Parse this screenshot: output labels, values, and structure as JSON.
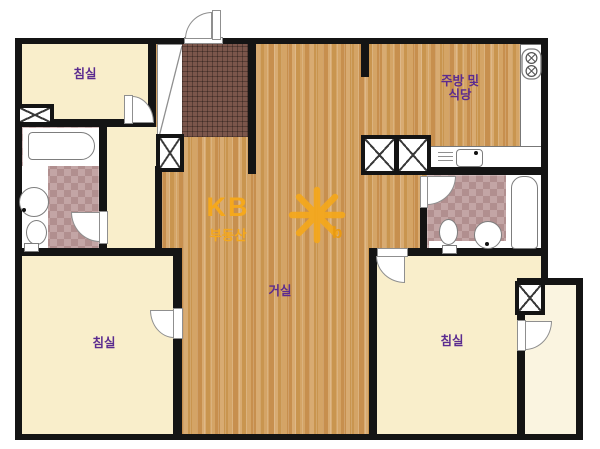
{
  "title": "apartment-floor-plan",
  "watermark": {
    "brand": "KB",
    "sub": "부동산",
    "star_letter": "b"
  },
  "rooms": [
    {
      "id": "bedroom-top-left",
      "label": "침실"
    },
    {
      "id": "kitchen-dining",
      "label": "주방 및 식당",
      "label_lines": [
        "주방 및",
        "식당"
      ]
    },
    {
      "id": "living-room",
      "label": "거실"
    },
    {
      "id": "bedroom-bottom-left",
      "label": "침실"
    },
    {
      "id": "bedroom-bottom-right",
      "label": "침실"
    }
  ],
  "colors": {
    "wall": "#141414",
    "bedroom_floor": "#f9eecb",
    "balcony_floor": "#faf4e0",
    "wood_floor": "#d0a169",
    "entry_tile": "#7b564b",
    "bath_tile": "#b99a9a",
    "label_text": "#5b2b8f",
    "watermark_orange": "#f5a81c"
  }
}
